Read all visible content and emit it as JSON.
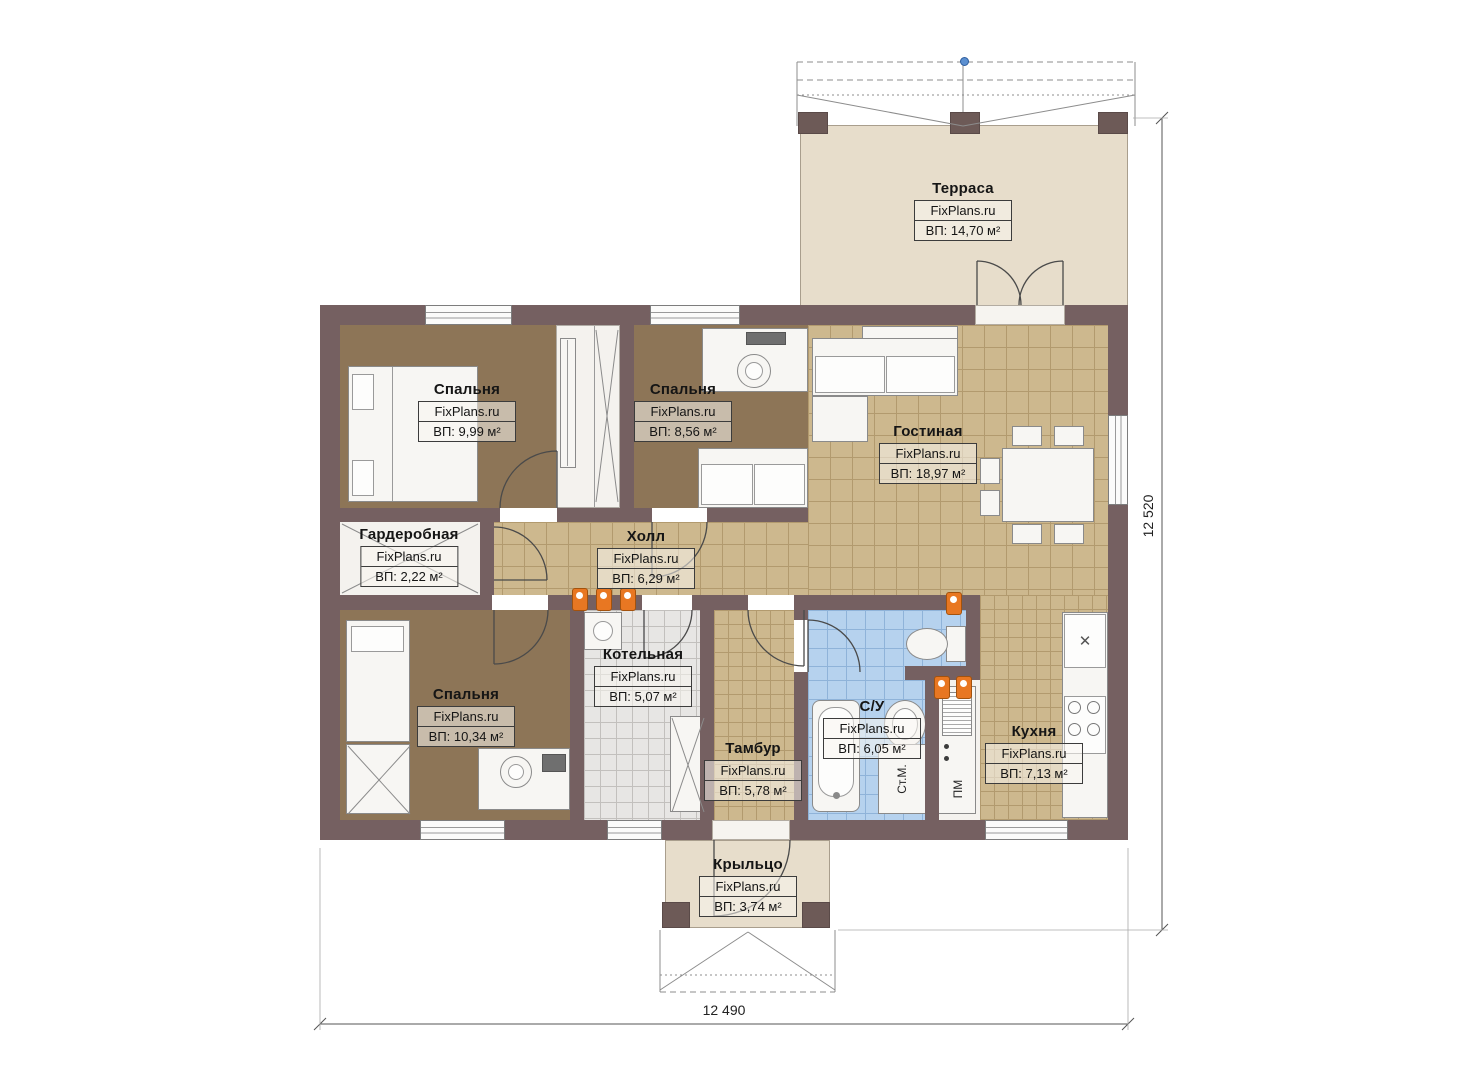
{
  "plan": {
    "watermark": "FixPlans.ru",
    "rooms": [
      {
        "id": "terrace",
        "name": "Терраса",
        "area": "ВП: 14,70 м²"
      },
      {
        "id": "bedroom-1",
        "name": "Спальня",
        "area": "ВП: 9,99 м²"
      },
      {
        "id": "bedroom-2",
        "name": "Спальня",
        "area": "ВП: 8,56 м²"
      },
      {
        "id": "living-room",
        "name": "Гостиная",
        "area": "ВП: 18,97 м²"
      },
      {
        "id": "wardrobe",
        "name": "Гардеробная",
        "area": "ВП: 2,22 м²"
      },
      {
        "id": "hall",
        "name": "Холл",
        "area": "ВП: 6,29 м²"
      },
      {
        "id": "bedroom-3",
        "name": "Спальня",
        "area": "ВП: 10,34 м²"
      },
      {
        "id": "boiler-room",
        "name": "Котельная",
        "area": "ВП: 5,07 м²"
      },
      {
        "id": "vestibule",
        "name": "Тамбур",
        "area": "ВП: 5,78 м²"
      },
      {
        "id": "bathroom",
        "name": "С/У",
        "area": "ВП: 6,05 м²"
      },
      {
        "id": "kitchen",
        "name": "Кухня",
        "area": "ВП: 7,13 м²"
      },
      {
        "id": "porch",
        "name": "Крыльцо",
        "area": "ВП: 3,74 м²"
      }
    ],
    "appliance_labels": {
      "washing_machine": "Ст.М.",
      "dishwasher": "ПМ"
    },
    "dimensions": {
      "horizontal": "12 490",
      "vertical": "12 520"
    },
    "icons": {
      "sink_cross": "✕"
    },
    "colors": {
      "wall": "#756061",
      "wood_floor": "#8d7557",
      "tile_floor": "#cdb88e",
      "bath_tile": "#b6d2ee",
      "boiler_tile": "#e7e6e4",
      "terrace_floor": "#e7ddcb",
      "radiator": "#e87722"
    }
  }
}
